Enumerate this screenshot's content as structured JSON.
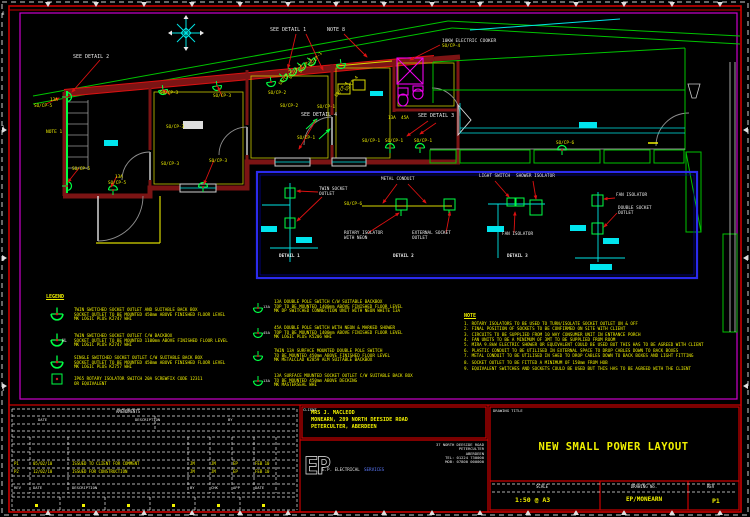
{
  "plan": {
    "labels": [
      {
        "t": [
          "SEE DETAIL 2"
        ],
        "x": 73,
        "y": 55,
        "c": "w",
        "fs": 5,
        "n": "see-detail-2-label"
      },
      {
        "t": [
          "SEE DETAIL 1"
        ],
        "x": 270,
        "y": 28,
        "c": "w",
        "fs": 5,
        "n": "see-detail-1-label"
      },
      {
        "t": [
          "NOTE 8"
        ],
        "x": 327,
        "y": 28,
        "c": "w",
        "fs": 5,
        "n": "note-8-ref-label"
      },
      {
        "t": [
          "10KW ELECTRIC COOKER"
        ],
        "x": 442,
        "y": 39,
        "c": "w",
        "fs": 4.5,
        "n": "cooker-label"
      },
      {
        "t": [
          "SO/CP-4"
        ],
        "x": 442,
        "y": 45,
        "n": "cooker-circuit-label"
      },
      {
        "t": [
          "SEE DETAIL 4"
        ],
        "x": 301,
        "y": 113,
        "c": "w",
        "fs": 5,
        "n": "see-detail-4-label"
      },
      {
        "t": [
          "SEE DETAIL 3"
        ],
        "x": 418,
        "y": 114,
        "c": "w",
        "fs": 5,
        "n": "see-detail-3-label"
      },
      {
        "t": [
          "NOTE 1"
        ],
        "x": 46,
        "y": 130,
        "fs": 4.5,
        "n": "note-1-ref-label"
      },
      {
        "t": [
          "13A"
        ],
        "x": 50,
        "y": 99
      },
      {
        "t": [
          "SO/CP-5"
        ],
        "x": 34,
        "y": 105
      },
      {
        "t": [
          "SO/CP-5"
        ],
        "x": 72,
        "y": 168
      },
      {
        "t": [
          "13A"
        ],
        "x": 115,
        "y": 176
      },
      {
        "t": [
          "SO/CP-5"
        ],
        "x": 108,
        "y": 182
      },
      {
        "t": [
          "SO/CP-3"
        ],
        "x": 160,
        "y": 92
      },
      {
        "t": [
          "SO/CP-3"
        ],
        "x": 213,
        "y": 95
      },
      {
        "t": [
          "SO/CP-3"
        ],
        "x": 166,
        "y": 126
      },
      {
        "t": [
          "SO/CP-3"
        ],
        "x": 161,
        "y": 163
      },
      {
        "t": [
          "SO/CP-3"
        ],
        "x": 209,
        "y": 160
      },
      {
        "t": [
          "SO/CP-2"
        ],
        "x": 268,
        "y": 92
      },
      {
        "t": [
          "SO/CP-2"
        ],
        "x": 280,
        "y": 105
      },
      {
        "t": [
          "SO/CP-2"
        ],
        "x": 279,
        "y": 84,
        "r": -50
      },
      {
        "t": [
          "SO/CP-2"
        ],
        "x": 289,
        "y": 78,
        "r": -50
      },
      {
        "t": [
          "SO/CP-1"
        ],
        "x": 299,
        "y": 72,
        "r": -50
      },
      {
        "t": [
          "SO/CP-1"
        ],
        "x": 309,
        "y": 66,
        "r": -50
      },
      {
        "t": [
          "SO/CP-1"
        ],
        "x": 317,
        "y": 106
      },
      {
        "t": [
          "SO/CP-1"
        ],
        "x": 297,
        "y": 137
      },
      {
        "t": [
          "SO/CP-4"
        ],
        "x": 335,
        "y": 96,
        "r": -50
      },
      {
        "t": [
          "SO/CP-4"
        ],
        "x": 345,
        "y": 90,
        "r": -50
      },
      {
        "t": [
          "13A"
        ],
        "x": 388,
        "y": 117
      },
      {
        "t": [
          "45A"
        ],
        "x": 401,
        "y": 117
      },
      {
        "t": [
          "SO/CP-1"
        ],
        "x": 362,
        "y": 140
      },
      {
        "t": [
          "SO/CP-1"
        ],
        "x": 385,
        "y": 140
      },
      {
        "t": [
          "SO/CP-1"
        ],
        "x": 414,
        "y": 140
      },
      {
        "t": [
          "SO/CP-6"
        ],
        "x": 556,
        "y": 142
      },
      {
        "t": [
          "TWIN SOCKET",
          "OUTLET"
        ],
        "x": 319,
        "y": 188,
        "c": "w",
        "n": "detail1-twin-socket-label"
      },
      {
        "t": [
          "METAL CONDUIT"
        ],
        "x": 381,
        "y": 178,
        "c": "w",
        "n": "detail2-metal-conduit-label"
      },
      {
        "t": [
          "SO/CP-6"
        ],
        "x": 344,
        "y": 203
      },
      {
        "t": [
          "ROTARY ISOLATOR",
          "WITH NEON"
        ],
        "x": 344,
        "y": 232,
        "c": "w",
        "n": "detail2-rotary-isolator-label"
      },
      {
        "t": [
          "EXTERNAL SOCKET",
          "OUTLET"
        ],
        "x": 412,
        "y": 232,
        "c": "w",
        "n": "detail2-external-socket-label"
      },
      {
        "t": [
          "LIGHT SWITCH"
        ],
        "x": 479,
        "y": 175,
        "c": "w",
        "n": "detail3-light-switch-label"
      },
      {
        "t": [
          "SHOWER ISOLATOR"
        ],
        "x": 516,
        "y": 175,
        "c": "w",
        "n": "detail3-shower-isolator-label"
      },
      {
        "t": [
          "FAN ISOLATOR"
        ],
        "x": 502,
        "y": 233,
        "c": "w",
        "n": "detail3-fan-isolator-label"
      },
      {
        "t": [
          "FAN ISOLATOR"
        ],
        "x": 616,
        "y": 194,
        "c": "w",
        "n": "detail4-fan-isolator-label"
      },
      {
        "t": [
          "DOUBLE SOCKET",
          "OUTLET"
        ],
        "x": 618,
        "y": 207,
        "c": "w",
        "n": "detail4-double-socket-label"
      },
      {
        "t": [
          "DETAIL 1"
        ],
        "x": 279,
        "y": 255,
        "c": "w",
        "b": true,
        "n": "detail-1-caption"
      },
      {
        "t": [
          "DETAIL 2"
        ],
        "x": 393,
        "y": 255,
        "c": "w",
        "b": true,
        "n": "detail-2-caption"
      },
      {
        "t": [
          "DETAIL 3"
        ],
        "x": 507,
        "y": 255,
        "c": "w",
        "b": true,
        "n": "detail-3-caption"
      },
      {
        "t": [
          "HL"
        ],
        "x": 62,
        "y": 339,
        "c": "w",
        "fs": 4
      },
      {
        "t": [
          "13A"
        ],
        "x": 263,
        "y": 305,
        "c": "w",
        "fs": 3.8
      },
      {
        "t": [
          "45A"
        ],
        "x": 263,
        "y": 331,
        "c": "w",
        "fs": 3.8
      },
      {
        "t": [
          "13A"
        ],
        "x": 263,
        "y": 379,
        "c": "w",
        "fs": 3.8
      },
      {
        "t": [
          "8"
        ],
        "x": 2,
        "y": 12,
        "c": "w",
        "fs": 4
      },
      {
        "t": [
          "3"
        ],
        "x": 2,
        "y": 126,
        "c": "w",
        "fs": 4
      },
      {
        "t": [
          "8"
        ],
        "x": 2,
        "y": 258,
        "c": "w",
        "fs": 4
      },
      {
        "t": [
          "3"
        ],
        "x": 2,
        "y": 388,
        "c": "w",
        "fs": 4
      },
      {
        "t": [
          "CLIENT"
        ],
        "x": 303,
        "y": 408,
        "c": "w",
        "fs": 3.8,
        "n": "client-label"
      },
      {
        "t": [
          "DRAWING TITLE"
        ],
        "x": 493,
        "y": 409,
        "c": "w",
        "fs": 3.8,
        "n": "drawing-title-label"
      },
      {
        "t": [
          "AMENDMENTS"
        ],
        "x": 116,
        "y": 410,
        "c": "w",
        "fs": 4
      },
      {
        "t": [
          "DATE"
        ],
        "x": 38,
        "y": 418,
        "c": "w",
        "fs": 3.8
      },
      {
        "t": [
          "DESCRIPTION"
        ],
        "x": 135,
        "y": 418,
        "c": "w",
        "fs": 3.8
      },
      {
        "t": [
          "BY"
        ],
        "x": 228,
        "y": 418,
        "c": "w",
        "fs": 3.8
      },
      {
        "t": [
          "E.P. ELECTRICAL"
        ],
        "x": 322,
        "y": 468,
        "c": "w",
        "fs": 4.2,
        "n": "company-name"
      },
      {
        "t": [
          "SERVICES"
        ],
        "x": 364,
        "y": 468,
        "c": "b",
        "fs": 4.2,
        "n": "company-name-2"
      },
      {
        "t": [
          "37 NORTH DEESIDE ROAD",
          "PETERCULTER",
          "ABERDEEN",
          "TEL: 01224 730000",
          "MOB: 07800 000000"
        ],
        "x": 484,
        "y": 443,
        "c": "w",
        "fs": 3.8,
        "a": "r",
        "n": "company-contact"
      }
    ]
  },
  "legend": {
    "title": "LEGEND",
    "col1": [
      {
        "lines": [
          "TWIN SWITCHED SOCKET OUTLET AND SUITABLE BACK BOX",
          "SOCKET OUTLET TO BE MOUNTED 450mm ABOVE FINISHED FLOOR LEVEL",
          "MK LOGIC PLUS K2747 WHI"
        ]
      },
      {
        "lines": [
          "TWIN SWITCHED SOCKET OUTLET C/W BACKBOX",
          "SOCKET OUTLET TO BE MOUNTED 1100mm ABOVE FINISHED FLOOR LEVEL",
          "MK LOGIC PLUS K2747 WHI"
        ]
      },
      {
        "lines": [
          "SINGLE SWITCHED SOCKET OUTLET C/W SUITABLE BACK BOX",
          "SOCKET OUTLET TO BE MOUNTED 450mm ABOVE FINISHED FLOOR LEVEL",
          "MK LOGIC PLUS K2757 WHI"
        ]
      },
      {
        "lines": [
          "IP65 ROTARY ISOLATOR SWITCH 20A SCREWFIX CODE 12311",
          "OR EQUIVALENT"
        ]
      }
    ],
    "col2": [
      {
        "lines": [
          "13A DOUBLE POLE SWITCH C/W SUITABLE BACKBOX",
          "TOP TO BE MOUNTED 1400mm ABOVE FINISHED FLOOR LEVEL",
          "MK DP SWITCHED CONNECTION UNIT WITH NEON WHITE 13A"
        ]
      },
      {
        "lines": [
          "45A DOUBLE POLE SWITCH WITH NEON & MARKED SHOWER",
          "TOP TO BE MOUNTED 1400mm ABOVE FINISHED FLOOR LEVEL",
          "MK LOGIC PLUS K5206 WHI"
        ]
      },
      {
        "lines": [
          "TWIN 13A SURFACE MOUNTED DOUBLE POLE SWITCH",
          "TO BE MOUNTED 450mm ABOVE FINISHED FLOOR LEVEL",
          "MK METALCLAD K2859 ALM SUITABLE BACKBOX"
        ]
      },
      {
        "lines": [
          "13A SURFACE MOUNTED SOCKET OUTLET C/W SUITABLE BACK BOX",
          "TO BE MOUNTED 450mm ABOVE DECKING",
          "MK MASTERSEAL WHI"
        ]
      }
    ]
  },
  "notes": {
    "title": "NOTE",
    "items": [
      "1. ROTARY ISOLATORS TO BE USED TO TURN/ISOLATE SOCKET OUTLET ON & OFF",
      "2. FINAL POSITION OF SOCKETS TO BE CONFIRMED ON SITE WITH CLIENT",
      "3. CIRCUITS TO BE SUPPLIED FROM 10 WAY CONSUMER UNIT IN ENTRANCE PORCH",
      "4. FAN UNITS TO BE A MINIMUM OF 3MT TO BE SUPPLIED FROM ROOM",
      "5. MIRA 9.8kW ELECTRIC SHOWER OR EQUIVALENT COULD BE USED BUT THIS HAS TO BE AGREED WITH CLIENT",
      "6. PLASTIC CONDUIT TO BE UTILISED IN EXTERNAL SPACE TO DROP CABLES DOWN TO BACK BOXES",
      "7. METAL CONDUIT TO BE UTILISED IN SHED TO DROP CABLES DOWN TO BACK BOXES AND LIGHT FITTING",
      "8. SOCKET OUTLET TO BE FITTED A MINIMUM OF 150mm FROM HOB",
      "9. EQUIVALENT SWITCHES AND SOCKETS COULD BE USED BUT THIS HAS TO BE AGREED WITH THE CLIENT"
    ]
  },
  "title_block": {
    "client": [
      "MRS J. MACLEOD",
      "MONEARN, 289 NORTH DEESIDE ROAD",
      "PETERCULTER, ABERDEEN"
    ],
    "logo": "EP",
    "title": "NEW SMALL POWER LAYOUT",
    "scale_label": "SCALE",
    "scale": "1:50 @ A3",
    "drawing_no_label": "DRAWING No.",
    "drawing_no": "EP/MONEARN",
    "rev_label": "REV",
    "rev": "P1",
    "rev_headers": [
      "REV",
      "DATE",
      "DESCRIPTION",
      "BY",
      "CHK",
      "APP",
      "DATE"
    ],
    "revisions": [
      {
        "cells": [
          "P1",
          "05/02/10",
          "ISSUED TO CLIENT FOR COMMENT",
          "JM",
          "JM",
          "EP",
          "FEB 10"
        ]
      },
      {
        "cells": [
          "P2",
          "12/02/10",
          "ISSUED FOR CONSTRUCTION",
          "JM",
          "JM",
          "EP",
          "FEB 10"
        ]
      }
    ]
  },
  "colors": {
    "wall": "#7c1414",
    "accent_red": "#dd1111",
    "cad_green": "#00ff44",
    "cad_yellow": "#f0f000",
    "cad_cyan": "#00e5e5",
    "cad_magenta": "#ee00ee",
    "detail_box_blue": "#2b2bee",
    "frame_magenta": "#cc00cc"
  }
}
